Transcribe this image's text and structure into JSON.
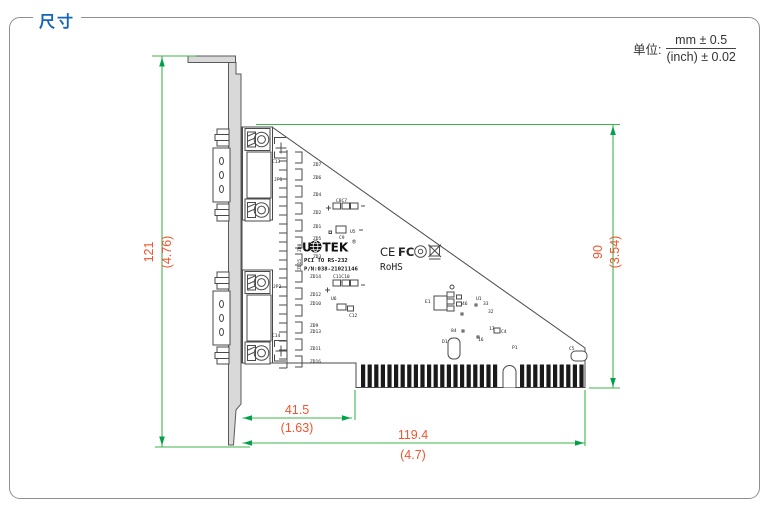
{
  "page": {
    "title": "尺寸",
    "unit_label": "单位:",
    "unit_mm": "mm ± 0.5",
    "unit_inch": "(inch) ± 0.02"
  },
  "dimensions": {
    "bracket_height_mm": "121",
    "bracket_height_in": "(4.76)",
    "board_height_mm": "90",
    "board_height_in": "(3.54)",
    "edge_offset_mm": "41.5",
    "edge_offset_in": "(1.63)",
    "board_length_mm": "119.4",
    "board_length_in": "(4.7)"
  },
  "board": {
    "logo_left": "U",
    "logo_right": "TEK",
    "logo_reg": "®",
    "product_line": "PCI TO RS-232",
    "part_number": "P/N:038-21021146",
    "rohs": "RoHS",
    "cert_ce": "CE",
    "cert_fcc": "FC"
  },
  "component_labels": [
    {
      "t": "ZD7",
      "x": 313,
      "y": 166
    },
    {
      "t": "ZD6",
      "x": 313,
      "y": 179
    },
    {
      "t": "ZD4",
      "x": 313,
      "y": 196
    },
    {
      "t": "ZD2",
      "x": 313,
      "y": 214
    },
    {
      "t": "ZD1",
      "x": 313,
      "y": 228
    },
    {
      "t": "ZD5",
      "x": 313,
      "y": 240
    },
    {
      "t": "ZD3",
      "x": 313,
      "y": 258
    },
    {
      "t": "ZD14",
      "x": 310,
      "y": 278
    },
    {
      "t": "ZD12",
      "x": 310,
      "y": 296
    },
    {
      "t": "ZD10",
      "x": 310,
      "y": 305
    },
    {
      "t": "U6",
      "x": 331,
      "y": 300
    },
    {
      "t": "ZD9",
      "x": 310,
      "y": 327
    },
    {
      "t": "ZD13",
      "x": 310,
      "y": 333
    },
    {
      "t": "ZD11",
      "x": 310,
      "y": 350
    },
    {
      "t": "ZD16",
      "x": 310,
      "y": 363
    },
    {
      "t": "C13",
      "x": 272,
      "y": 163
    },
    {
      "t": "JP1",
      "x": 274,
      "y": 181
    },
    {
      "t": "C14",
      "x": 272,
      "y": 337
    },
    {
      "t": "JP2",
      "x": 273,
      "y": 288
    },
    {
      "t": "C8C7",
      "x": 336,
      "y": 202
    },
    {
      "t": "U5",
      "x": 350,
      "y": 233
    },
    {
      "t": "C9",
      "x": 339,
      "y": 239
    },
    {
      "t": "C11C10",
      "x": 333,
      "y": 278
    },
    {
      "t": "C12",
      "x": 349,
      "y": 317
    },
    {
      "t": "E1",
      "x": 425,
      "y": 303
    },
    {
      "t": "46",
      "x": 462,
      "y": 305
    },
    {
      "t": "U1",
      "x": 476,
      "y": 300
    },
    {
      "t": "33",
      "x": 483,
      "y": 305
    },
    {
      "t": "32",
      "x": 488,
      "y": 313
    },
    {
      "t": "84",
      "x": 451,
      "y": 332
    },
    {
      "t": "17",
      "x": 489,
      "y": 330
    },
    {
      "t": "C4",
      "x": 501,
      "y": 333
    },
    {
      "t": "16",
      "x": 478,
      "y": 341
    },
    {
      "t": "D1",
      "x": 442,
      "y": 343
    },
    {
      "t": "P1",
      "x": 512,
      "y": 349
    },
    {
      "t": "C5",
      "x": 569,
      "y": 350,
      "s": 4
    },
    {
      "t": "ZD15",
      "x": 301,
      "y": 270,
      "r": -90
    },
    {
      "t": "ZD8",
      "x": 301,
      "y": 252,
      "r": -90
    }
  ]
}
